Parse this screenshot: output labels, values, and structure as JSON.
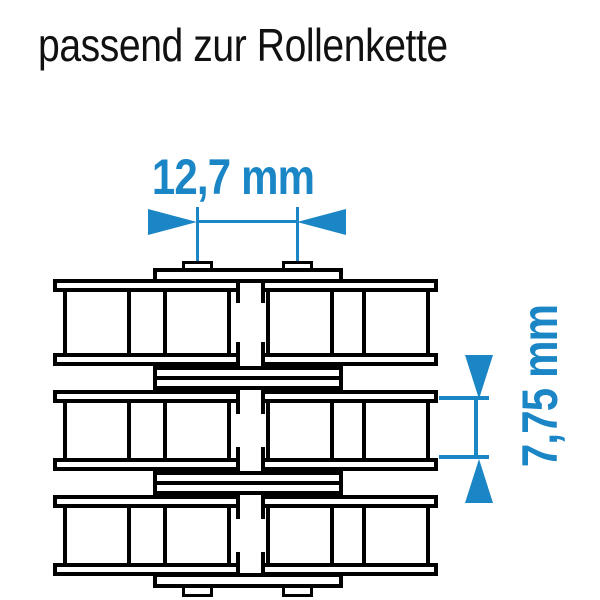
{
  "title": "passend zur Rollenkette",
  "diagram": {
    "type": "technical-drawing",
    "subject": "Rollenkette (roller chain), plan view",
    "strands": 2,
    "link_rows": 3,
    "rollers_per_row": 4,
    "pins_per_row": 2
  },
  "dimensions": {
    "pitch": {
      "label": "12,7 mm",
      "value": 12.7,
      "unit": "mm",
      "orientation": "horizontal"
    },
    "inner_width": {
      "label": "7,75 mm",
      "value": 7.75,
      "unit": "mm",
      "orientation": "vertical"
    }
  },
  "colors": {
    "accent": "#1b86c6",
    "line": "#000000",
    "background": "#ffffff",
    "text": "#111111"
  }
}
